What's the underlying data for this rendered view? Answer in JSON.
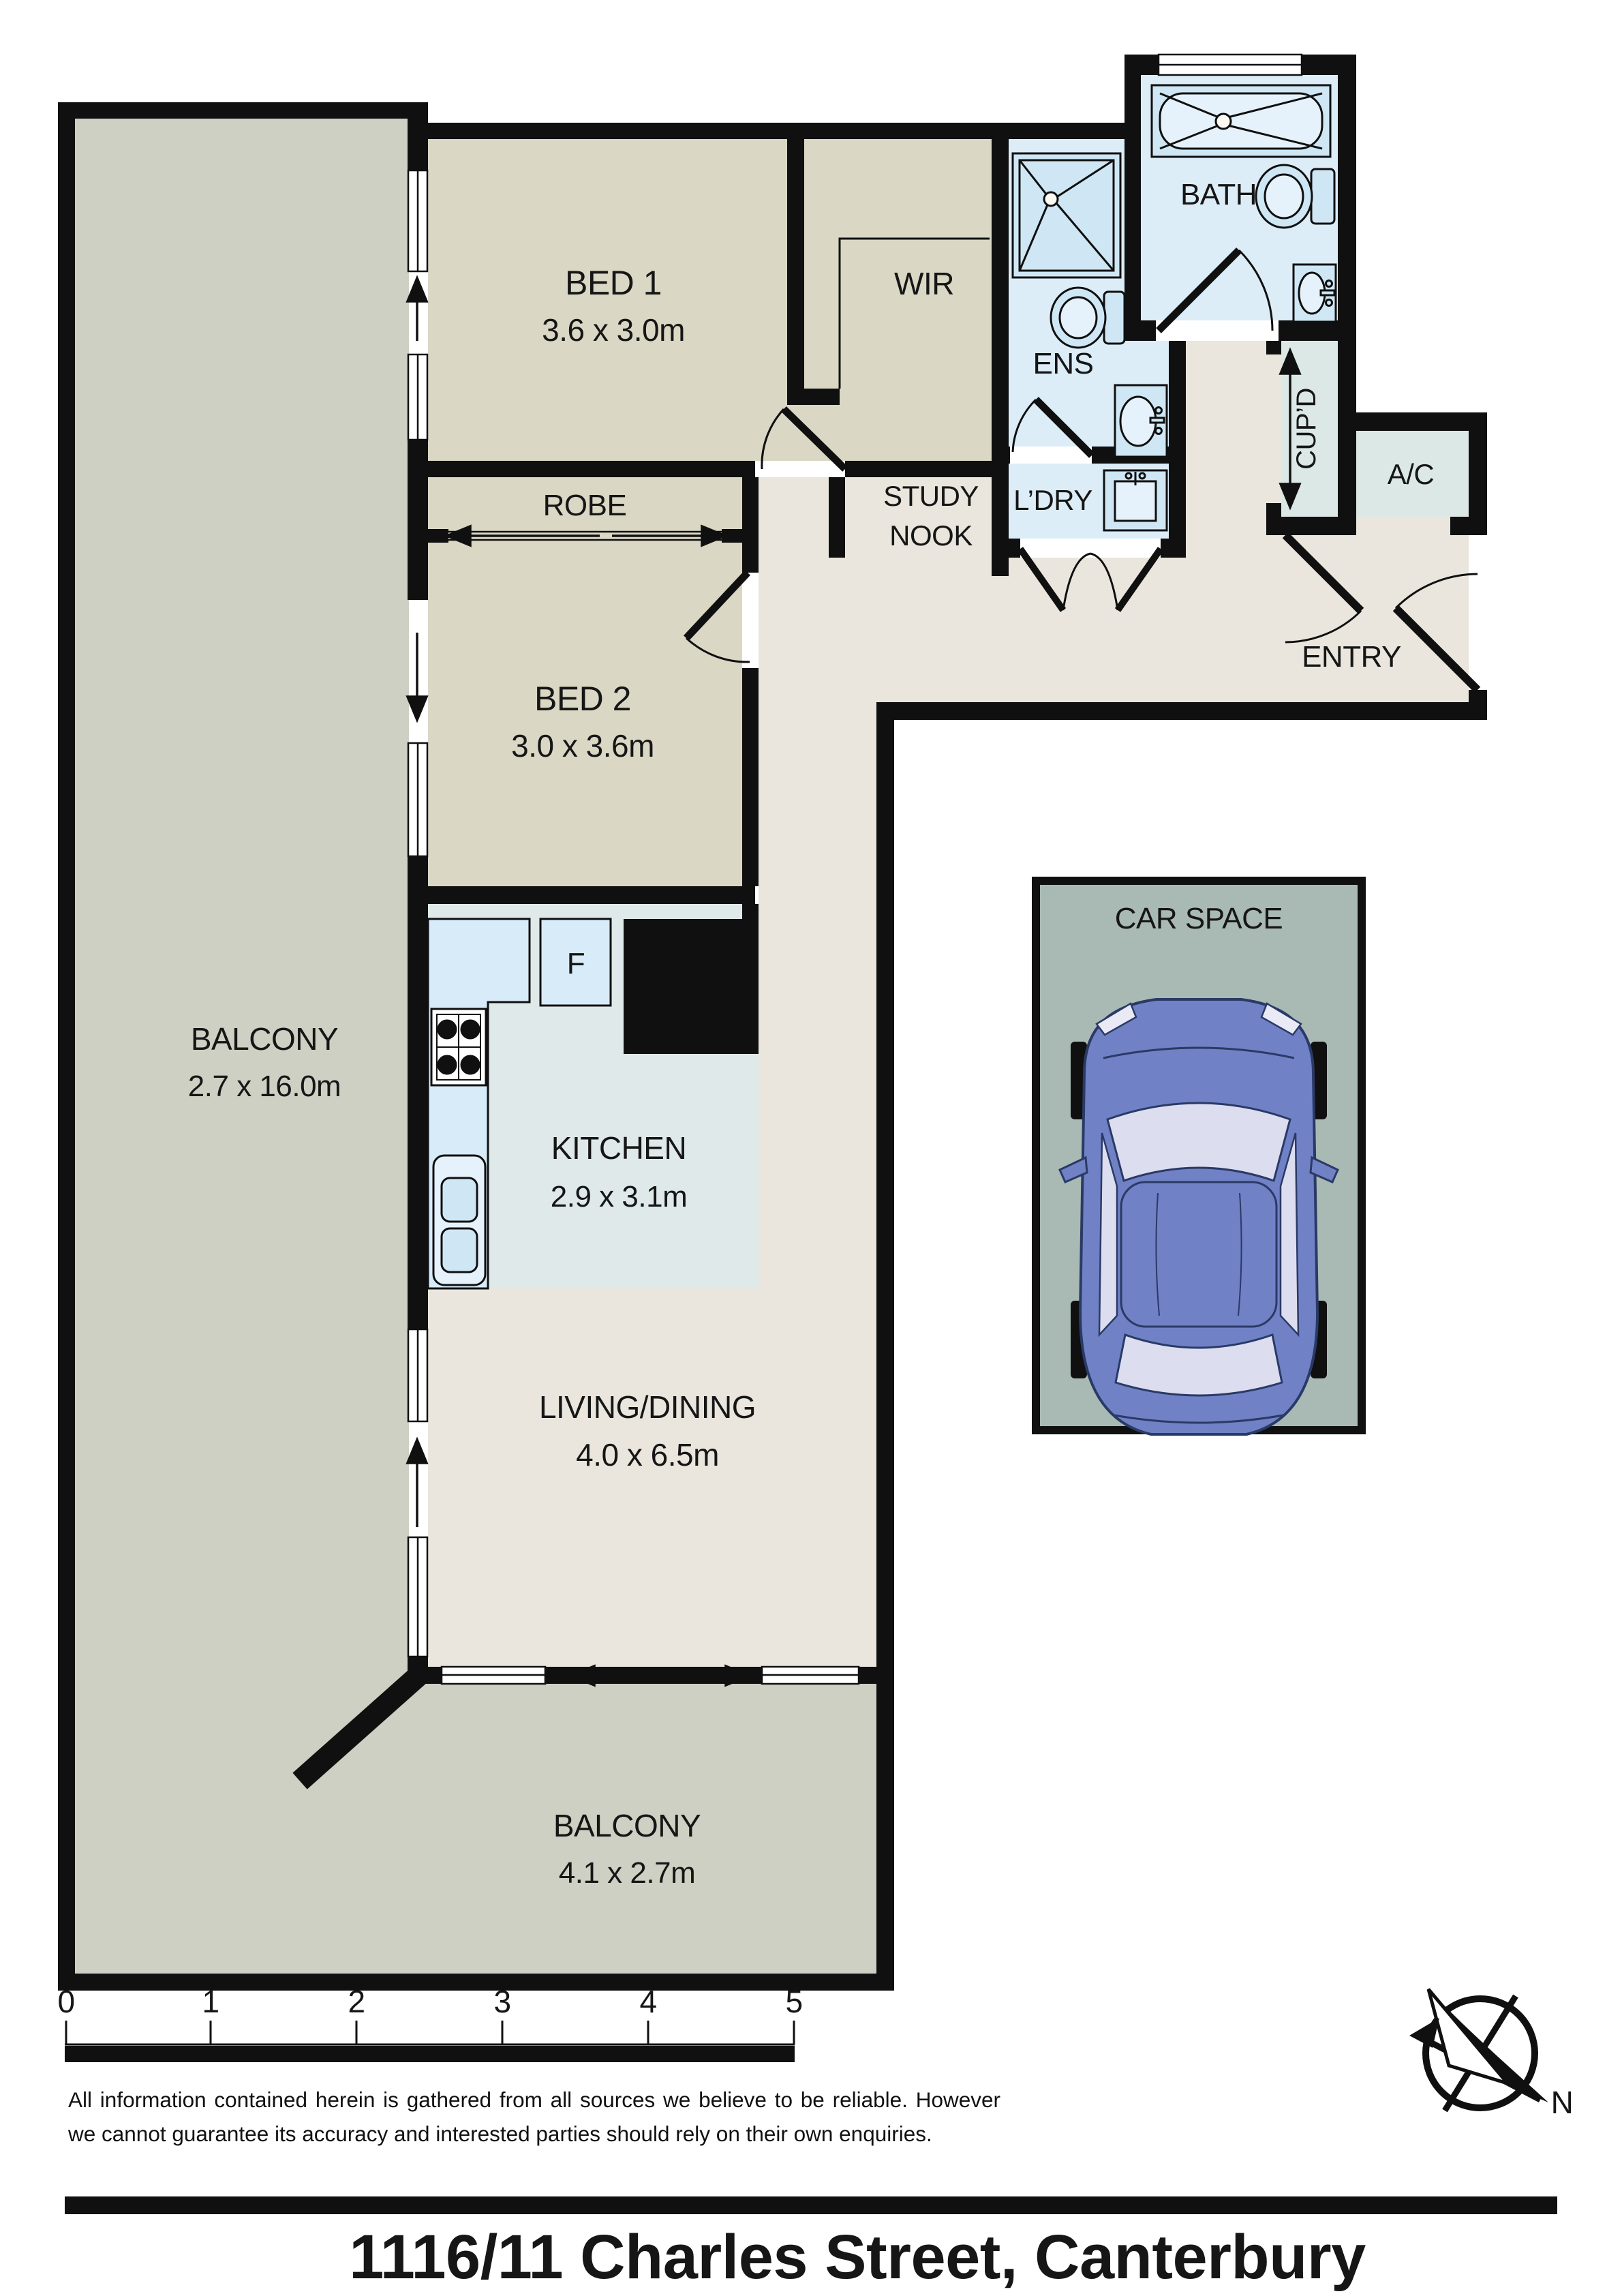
{
  "title": "1116/11 Charles Street, Canterbury",
  "disclaimer": "All information contained herein is gathered from all sources we believe to be reliable. However we cannot guarantee its accuracy and interested parties should rely on their own enquiries.",
  "compass": {
    "north_label": "N"
  },
  "scale": {
    "ticks": [
      "0",
      "1",
      "2",
      "3",
      "4",
      "5"
    ]
  },
  "rooms": {
    "bed1": {
      "name": "BED 1",
      "dims": "3.6 x 3.0m"
    },
    "bed2": {
      "name": "BED 2",
      "dims": "3.0 x 3.6m"
    },
    "robe": {
      "name": "ROBE"
    },
    "wir": {
      "name": "WIR"
    },
    "ens": {
      "name": "ENS"
    },
    "bath": {
      "name": "BATH"
    },
    "study_nook": {
      "line1": "STUDY",
      "line2": "NOOK"
    },
    "ldry": {
      "name": "L’DRY"
    },
    "cupd": {
      "name": "CUP’D"
    },
    "ac": {
      "name": "A/C"
    },
    "entry": {
      "name": "ENTRY"
    },
    "kitchen": {
      "name": "KITCHEN",
      "dims": "2.9 x 3.1m"
    },
    "fridge": {
      "name": "F"
    },
    "living": {
      "name": "LIVING/DINING",
      "dims": "4.0 x 6.5m"
    },
    "balcony_side": {
      "name": "BALCONY",
      "dims": "2.7 x 16.0m"
    },
    "balcony_rear": {
      "name": "BALCONY",
      "dims": "4.1 x 2.7m"
    },
    "car_space": {
      "name": "CAR SPACE"
    }
  },
  "colors": {
    "wall": "#101010",
    "balcony": "#ced0c3",
    "bedroom_beige": "#dad7c4",
    "floor_cream": "#eae6dd",
    "wet_blue": "#dcedf8",
    "fixture_blue": "#cfe7f5",
    "fixture_light": "#e6f2fb",
    "kitchen_grey": "#dfe9e9",
    "utility_grey": "#dce8e6",
    "counter_blue": "#d7ebf8",
    "carspace_grey": "#a9bab5",
    "car_blue": "#7081c6",
    "car_window": "#dcdef0",
    "car_outline": "#2a3a66"
  }
}
